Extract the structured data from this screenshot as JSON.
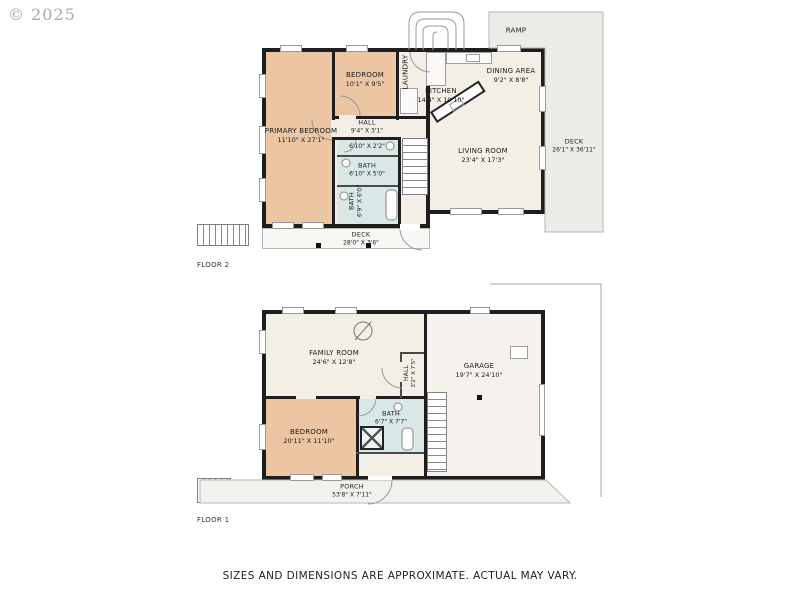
{
  "watermark": "© 2025",
  "disclaimer": "SIZES AND DIMENSIONS ARE APPROXIMATE. ACTUAL MAY VARY.",
  "colors": {
    "wall": "#1e1e1e",
    "bedroom_fill": "#ecc5a3",
    "living_fill": "#f3eee6",
    "bath_fill": "#d9e8e7",
    "garage_fill": "#f5f1ec",
    "outdoor_fill": "#ecebe7",
    "outline": "#b7b5b0",
    "label_text": "#1c1c1c"
  },
  "floor2": {
    "title": "FLOOR 2",
    "rooms": {
      "primary_bedroom": {
        "name": "PRIMARY BEDROOM",
        "dims": "11'10\" X 27'1\""
      },
      "bedroom": {
        "name": "BEDROOM",
        "dims": "10'1\" X 9'5\""
      },
      "laundry": {
        "name": "LAUNDRY"
      },
      "kitchen": {
        "name": "KITCHEN",
        "dims": "14'4\" X 10'10\""
      },
      "dining": {
        "name": "DINING AREA",
        "dims": "9'2\" X 8'8\""
      },
      "living": {
        "name": "LIVING ROOM",
        "dims": "23'4\" X 17'3\""
      },
      "hall": {
        "name": "HALL",
        "dims": "9'4\" X 3'1\""
      },
      "bath_small": {
        "dims": "6'10\" X 2'2\""
      },
      "bath_mid": {
        "name": "BATH",
        "dims": "6'10\" X 5'0\""
      },
      "bath_lower": {
        "name": "BATH",
        "dims": "6'9\" X 6'0\""
      },
      "deck_rear": {
        "name": "DECK",
        "dims": "28'0\" X 3'6\""
      },
      "deck_side": {
        "name": "DECK",
        "dims": "26'1\" X 36'11\""
      },
      "ramp": {
        "name": "RAMP"
      }
    }
  },
  "floor1": {
    "title": "FLOOR 1",
    "rooms": {
      "family": {
        "name": "FAMILY ROOM",
        "dims": "24'6\" X 12'8\""
      },
      "garage": {
        "name": "GARAGE",
        "dims": "19'7\" X 24'10\""
      },
      "bedroom": {
        "name": "BEDROOM",
        "dims": "20'11\" X 11'10\""
      },
      "bath": {
        "name": "BATH",
        "dims": "6'7\" X 7'7\""
      },
      "hall": {
        "name": "HALL",
        "dims": "3'2\" X 7'5\""
      },
      "porch": {
        "name": "PORCH",
        "dims": "53'8\" X 7'11\""
      }
    }
  }
}
